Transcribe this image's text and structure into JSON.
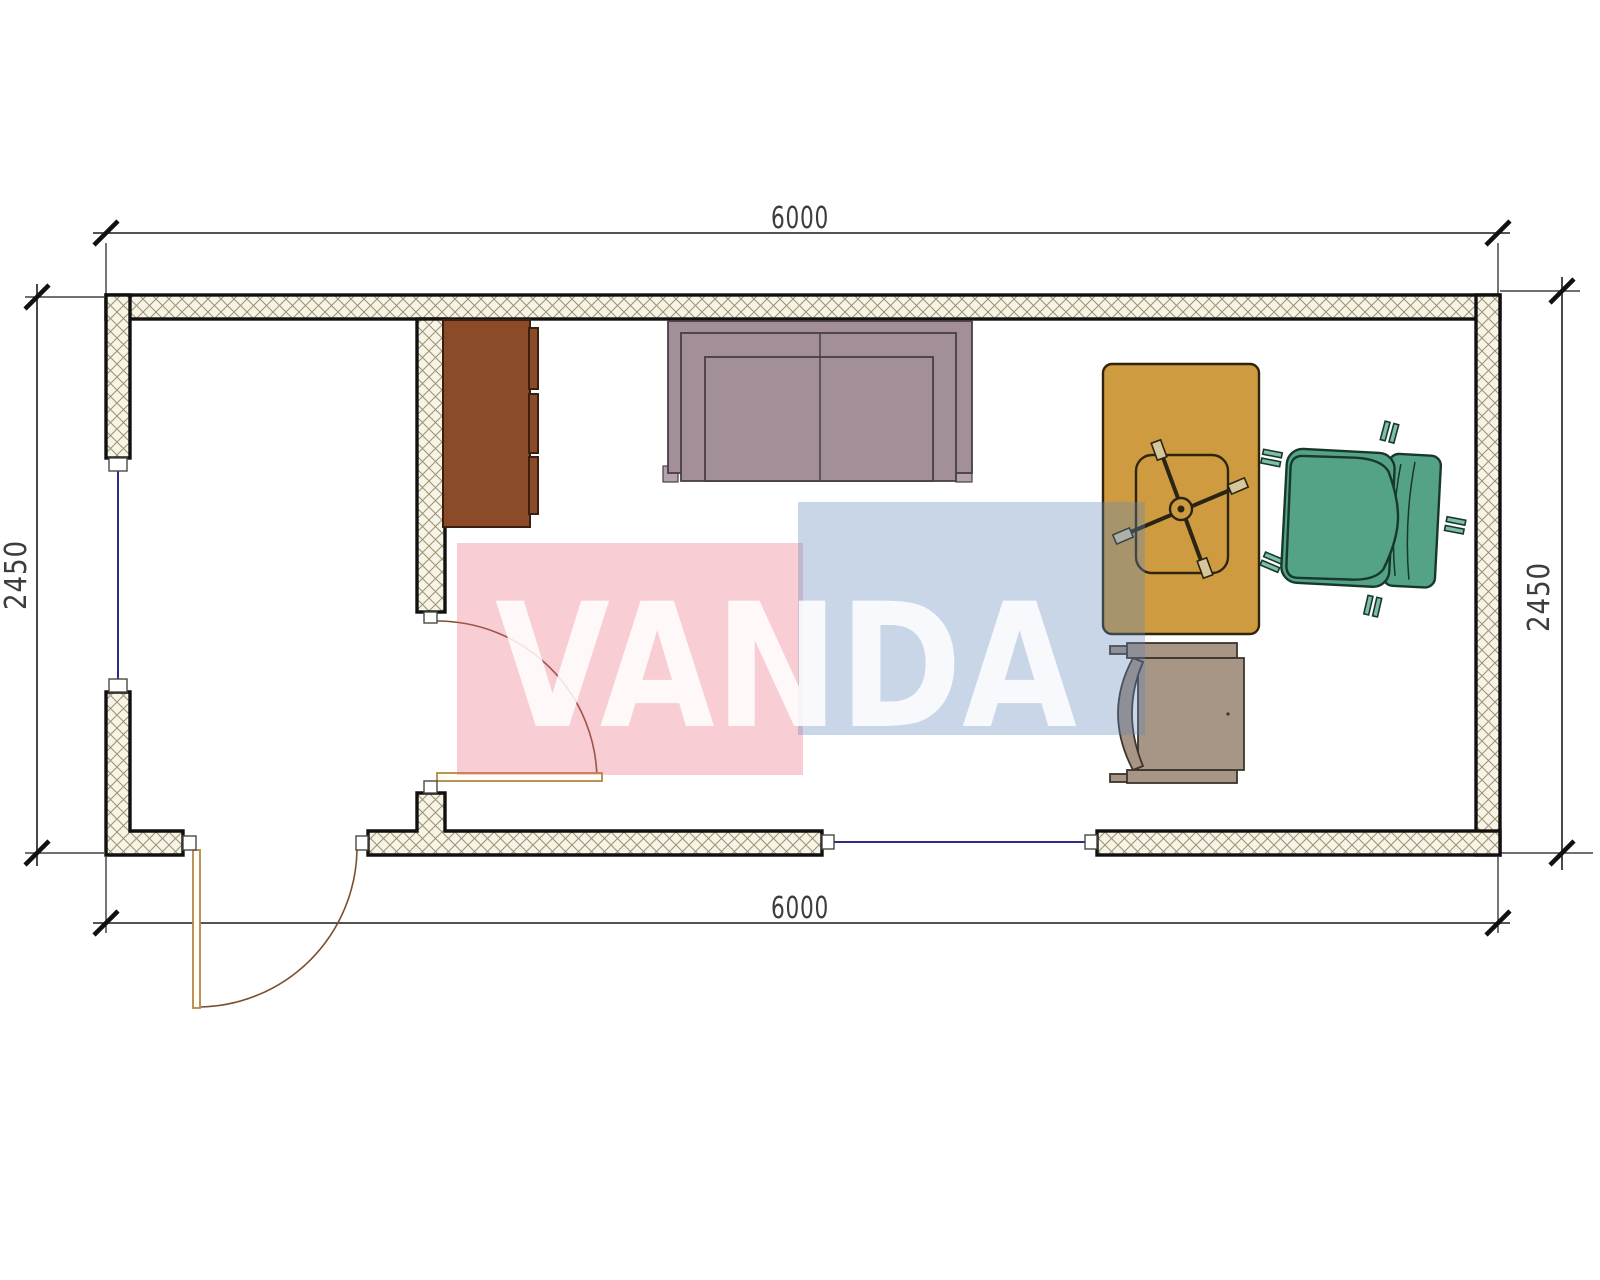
{
  "drawing": {
    "type": "floor-plan",
    "room_outer_width_label": "6000",
    "room_outer_depth_label": "2450"
  },
  "dimensions": {
    "top": "6000",
    "bottom": "6000",
    "left": "2450",
    "right": "2450"
  },
  "watermark": {
    "text": "VANDA",
    "pink_color": "#E96276",
    "blue_color": "#6088BB",
    "letter_color": "#FFFFFF"
  },
  "plan_colors": {
    "wall_hatch_fill": "#F7F3E6",
    "wall_hatch_line": "#9A9170",
    "wall_edge": "#111111",
    "window_line": "#2B2B8C",
    "door_leaf": "#B08948",
    "door_swing": "#7A4E33"
  },
  "furniture": {
    "cabinet": {
      "name": "cabinet",
      "color": "#8C4B28"
    },
    "sofa": {
      "name": "sofa",
      "color": "#A28F99"
    },
    "sofa_feet": {
      "color": "#B3A3AC"
    },
    "desk": {
      "name": "desk",
      "color": "#CE9B41"
    },
    "desk_chair": {
      "name": "desk-chair-base",
      "wheel_color": "#D6C79B"
    },
    "armchair": {
      "name": "office-armchair",
      "color": "#55A386",
      "leg_color": "#7FBFA5"
    },
    "guest_chair": {
      "name": "guest-chair",
      "color": "#A79585"
    }
  }
}
